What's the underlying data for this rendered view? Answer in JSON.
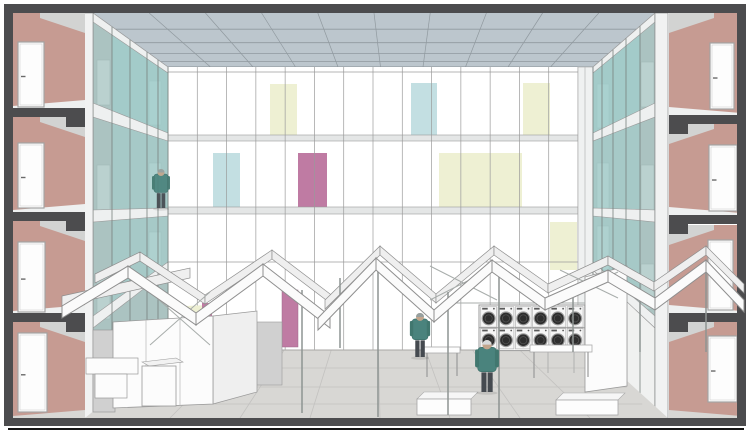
{
  "palette": {
    "frame_dark": "#4c4c4e",
    "wall_pink": "#c69b92",
    "room_gray": "#d2d3d2",
    "door_white": "#fdfdfd",
    "door_frame": "#a3a3a3",
    "ceiling_blue": "#bcc6cd",
    "ceiling_line": "#90999f",
    "back_wall": "#ffffff",
    "grid_line": "#9b9b9b",
    "band_gray": "#e4e6e6",
    "glass_teal": "#aed7d5",
    "glass_teal_deep": "#9fd0ce",
    "gallery_gray": "#a9afad",
    "gallery_door": "#c6cbc9",
    "slab_white": "#eef0f0",
    "panel_yellow": "#eef0d3",
    "panel_blue": "#c3dfe2",
    "panel_magenta": "#bf7ba3",
    "floor_gray": "#d8d7d4",
    "floor_seam": "#c3c2c0",
    "stall_white": "#fcfcfc",
    "stall_side": "#efefef",
    "stall_gray": "#d0d0d0",
    "roof_white": "#fbfbfb",
    "roof_shade": "#efefef",
    "roof_line": "#8f8f8f",
    "post_gray": "#8e9492",
    "washer_dark": "#2e2e2e",
    "washer_ring": "#9c9c9c",
    "jacket_teal": "#4a837d",
    "pants_dark": "#454a50",
    "skin": "#c2a58c",
    "cap_gray": "#97a09f",
    "cap_light": "#d8dadb",
    "baseline_black": "#151515"
  },
  "ceiling": {
    "top_y": 13,
    "bot_y": 67,
    "top_x0": 93,
    "top_x1": 655,
    "bot_x0": 168,
    "bot_x1": 593,
    "cols": 10,
    "rows": [
      0.3,
      0.55,
      0.75,
      0.9
    ]
  },
  "back_wall": {
    "x": 168,
    "y": 67,
    "w": 410,
    "h": 283,
    "columns": 14,
    "thin_lines_y": [
      72,
      262
    ],
    "bands": [
      {
        "y": 135,
        "h": 6
      },
      {
        "y": 207,
        "h": 7
      }
    ],
    "panels": [
      {
        "x": 270,
        "y": 84,
        "w": 27,
        "h": 52,
        "color": "panel_yellow"
      },
      {
        "x": 213,
        "y": 153,
        "w": 27,
        "h": 54,
        "color": "panel_blue"
      },
      {
        "x": 298,
        "y": 153,
        "w": 29,
        "h": 54,
        "color": "panel_magenta"
      },
      {
        "x": 411,
        "y": 83,
        "w": 26,
        "h": 54,
        "color": "panel_blue"
      },
      {
        "x": 523,
        "y": 83,
        "w": 27,
        "h": 54,
        "color": "panel_yellow"
      },
      {
        "x": 439,
        "y": 153,
        "w": 83,
        "h": 54,
        "color": "panel_yellow"
      },
      {
        "x": 550,
        "y": 222,
        "w": 27,
        "h": 48,
        "color": "panel_yellow"
      }
    ]
  },
  "rooms": {
    "left": {
      "wall_x": 13,
      "wall_w": 72,
      "slab_ys": [
        108,
        212,
        313
      ],
      "floors_top": [
        13,
        117,
        221,
        322
      ],
      "floors_bottom": [
        108,
        212,
        313,
        418
      ],
      "doors": [
        {
          "x": 18,
          "y": 42,
          "w": 26,
          "h": 65
        },
        {
          "x": 18,
          "y": 143,
          "w": 26,
          "h": 65
        },
        {
          "x": 18,
          "y": 242,
          "w": 27,
          "h": 70
        },
        {
          "x": 18,
          "y": 333,
          "w": 29,
          "h": 79
        }
      ]
    },
    "right": {
      "wall_x": 669,
      "wall_w": 72,
      "slab_ys": [
        115,
        215,
        313
      ],
      "floors_top": [
        13,
        124,
        225,
        322
      ],
      "floors_bottom": [
        115,
        215,
        313,
        418
      ],
      "doors": [
        {
          "x": 710,
          "y": 43,
          "w": 24,
          "h": 66
        },
        {
          "x": 709,
          "y": 145,
          "w": 28,
          "h": 66
        },
        {
          "x": 708,
          "y": 240,
          "w": 25,
          "h": 70
        },
        {
          "x": 708,
          "y": 336,
          "w": 29,
          "h": 66
        }
      ]
    }
  },
  "washers": {
    "x": 480,
    "y": 306,
    "cols": 6,
    "rows": 2,
    "unit_w": 17.3,
    "unit_h": 21.8
  },
  "figures": [
    {
      "x": 161,
      "feet": 208,
      "h": 40,
      "cap": "cap_gray",
      "location": "gallery"
    },
    {
      "x": 420,
      "feet": 357,
      "h": 45,
      "cap": "cap_gray",
      "location": "floor"
    },
    {
      "x": 487,
      "feet": 392,
      "h": 53,
      "cap": "cap_light",
      "location": "floor"
    }
  ],
  "roof": {
    "ribbons": [
      {
        "pts": [
          [
            62,
            296
          ],
          [
            190,
            268
          ]
        ],
        "t": 10,
        "back": true
      },
      {
        "pts": [
          [
            95,
            274
          ],
          [
            140,
            252
          ],
          [
            205,
            295
          ],
          [
            272,
            250
          ],
          [
            338,
            300
          ]
        ],
        "t": 9,
        "back": true
      },
      {
        "pts": [
          [
            325,
            300
          ],
          [
            380,
            246
          ],
          [
            436,
            294
          ],
          [
            494,
            246
          ],
          [
            548,
            284
          ]
        ],
        "t": 9,
        "back": true
      },
      {
        "pts": [
          [
            548,
            284
          ],
          [
            608,
            256
          ],
          [
            654,
            282
          ],
          [
            706,
            246
          ],
          [
            744,
            284
          ]
        ],
        "t": 9,
        "back": true
      },
      {
        "pts": [
          [
            62,
            306
          ],
          [
            128,
            266
          ],
          [
            196,
            313
          ],
          [
            263,
            264
          ],
          [
            330,
            316
          ]
        ],
        "t": 12,
        "back": false
      },
      {
        "pts": [
          [
            318,
            318
          ],
          [
            376,
            258
          ],
          [
            434,
            310
          ],
          [
            492,
            260
          ],
          [
            545,
            298
          ]
        ],
        "t": 12,
        "back": false
      },
      {
        "pts": [
          [
            545,
            298
          ],
          [
            608,
            270
          ],
          [
            655,
            298
          ],
          [
            706,
            260
          ],
          [
            744,
            300
          ]
        ],
        "t": 12,
        "back": false
      }
    ],
    "posts": [
      [
        302,
        290,
        413
      ],
      [
        340,
        278,
        348
      ],
      [
        378,
        262,
        417
      ],
      [
        448,
        292,
        415
      ],
      [
        499,
        268,
        418
      ],
      [
        573,
        286,
        352
      ],
      [
        640,
        298,
        352
      ],
      [
        706,
        262,
        352
      ]
    ],
    "struts": [
      [
        150,
        345,
        210,
        292
      ],
      [
        210,
        345,
        150,
        292
      ],
      [
        430,
        300,
        497,
        266
      ],
      [
        497,
        300,
        430,
        266
      ],
      [
        560,
        298,
        618,
        272
      ],
      [
        618,
        298,
        560,
        270
      ],
      [
        445,
        303,
        585,
        303
      ]
    ]
  },
  "floor": {
    "front_y": 418,
    "back_y": 350,
    "radial_seams_front_x": [
      170,
      240,
      310,
      380,
      450,
      520,
      590
    ],
    "horizontal_seams_y": [
      368,
      387,
      404
    ]
  }
}
